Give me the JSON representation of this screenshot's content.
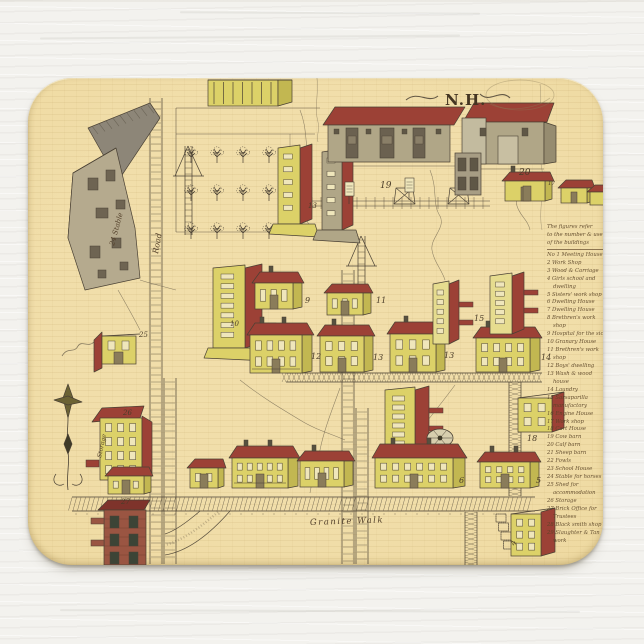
{
  "product": {
    "type_label": "mousepad",
    "colors": {
      "backdrop": "#f3f2ee",
      "parchment": "#eed9a0",
      "ink": "#4a4134",
      "ink_soft": "#6a5f4b",
      "roof_red": "#9c4136",
      "roof_red_dark": "#7e332b",
      "wall_yellow": "#dcd168",
      "wall_yellow_dark": "#c2b751",
      "wall_yellow_light": "#e6dc8f",
      "wall_gray": "#b0a687",
      "wall_gray_dark": "#968c70",
      "wall_gray_light": "#c3bb9f",
      "brick": "#9a5542",
      "chimney": "#56503f"
    }
  },
  "map": {
    "title": "N.H.",
    "place_labels": [
      {
        "t": "Road",
        "x": 130,
        "y": 176,
        "s": 8,
        "r": -80
      },
      {
        "t": "Granite Walk",
        "x": 282,
        "y": 447,
        "s": 8.5,
        "r": -2,
        "sp": 1.5
      },
      {
        "t": "24 Stable",
        "x": 86,
        "y": 168,
        "s": 7,
        "r": -75
      },
      {
        "t": "Storage",
        "x": 73,
        "y": 380,
        "s": 6,
        "r": -78
      }
    ],
    "number_labels": [
      {
        "t": "19",
        "x": 352,
        "y": 110,
        "s": 9
      },
      {
        "t": "20",
        "x": 491,
        "y": 97,
        "s": 9
      },
      {
        "t": "13",
        "x": 280,
        "y": 130,
        "s": 7
      },
      {
        "t": "17",
        "x": 520,
        "y": 107,
        "s": 5.5
      },
      {
        "t": "10",
        "x": 202,
        "y": 248,
        "s": 7
      },
      {
        "t": "9",
        "x": 277,
        "y": 225,
        "s": 8
      },
      {
        "t": "11",
        "x": 348,
        "y": 225,
        "s": 8
      },
      {
        "t": "12",
        "x": 283,
        "y": 281,
        "s": 8
      },
      {
        "t": "13",
        "x": 345,
        "y": 282,
        "s": 8
      },
      {
        "t": "13",
        "x": 416,
        "y": 280,
        "s": 8
      },
      {
        "t": "14",
        "x": 513,
        "y": 282,
        "s": 8
      },
      {
        "t": "15",
        "x": 446,
        "y": 243,
        "s": 8
      },
      {
        "t": "18",
        "x": 499,
        "y": 363,
        "s": 8
      },
      {
        "t": "6",
        "x": 431,
        "y": 405,
        "s": 8
      },
      {
        "t": "5",
        "x": 508,
        "y": 405,
        "s": 8
      },
      {
        "t": "4",
        "x": 487,
        "y": 468,
        "s": 8,
        "r": -70
      },
      {
        "t": "26",
        "x": 95,
        "y": 337,
        "s": 7
      },
      {
        "t": "27",
        "x": 93,
        "y": 426,
        "s": 7
      },
      {
        "t": "25",
        "x": 111,
        "y": 259,
        "s": 7
      }
    ],
    "legend": {
      "header_lines": [
        "The figures refer",
        "to the number & use",
        "of the buildings"
      ],
      "items": [
        "No 1 Meeting House",
        "2 Work Shop",
        "3 Wood & Carriage",
        "4 Girls school and dwelling",
        "5 Sisters' work shop",
        "6 Dwelling House",
        "7 Dwelling House",
        "8 Brethren's work shop",
        "9 Hospital for the sick",
        "10 Granary House",
        "11 Brethren's work shop",
        "12 Boys' dwelling",
        "13 Wash & wood house",
        "14 Laundry",
        "15 Sarsaparilla manufactory",
        "16 Engine House",
        "17 Work shop",
        "18 Cart House",
        "19 Cow barn",
        "20 Calf barn",
        "21 Sheep barn",
        "22 Fowls",
        "23 School House",
        "24 Stable for horses",
        "25 Shed for accommodation",
        "26 Storage",
        "27 Brick Office for Trustees",
        "28 Black smith shop",
        "29 Slaughter & Tan work"
      ]
    }
  }
}
